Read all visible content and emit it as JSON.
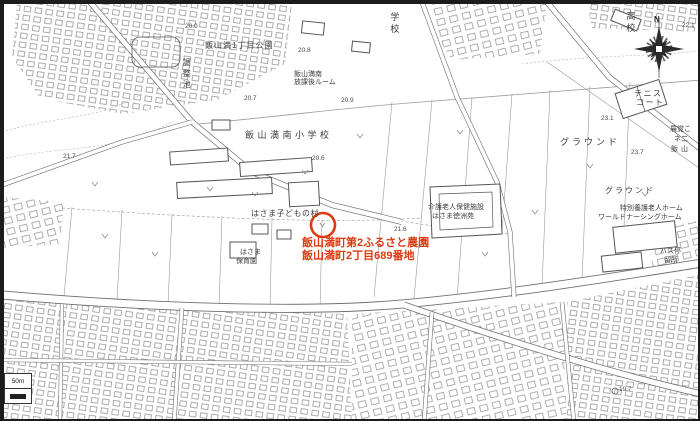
{
  "colors": {
    "accent_red": "#dc3a12",
    "map_line": "#7d7d7d",
    "label_text": "#3c3c3c"
  },
  "annotation": {
    "line1": "飯山満町第2ふるさと農園",
    "line2": "飯山満町2丁目689番地"
  },
  "compass": {
    "north_label": "N"
  },
  "scale": {
    "label": "50m"
  },
  "labels": [
    {
      "text": "学校",
      "x": 387,
      "y": 10,
      "size": 9,
      "vert": true
    },
    {
      "text": "飯山満1丁目公園",
      "x": 203,
      "y": 39,
      "size": 8,
      "ls": 1
    },
    {
      "text": "調整池",
      "x": 180,
      "y": 56,
      "size": 8,
      "vert": true
    },
    {
      "text": "飯山満南",
      "x": 292,
      "y": 69,
      "size": 7
    },
    {
      "text": "放課後ルーム",
      "x": 292,
      "y": 77,
      "size": 7
    },
    {
      "text": "飯山満南小学校",
      "x": 243,
      "y": 128,
      "size": 9,
      "ls": 3.5
    },
    {
      "text": "はさま子どもの村",
      "x": 249,
      "y": 207,
      "size": 8,
      "ls": 0.5
    },
    {
      "text": "はさま",
      "x": 238,
      "y": 247,
      "size": 7
    },
    {
      "text": "保育園",
      "x": 234,
      "y": 256,
      "size": 7
    },
    {
      "text": "介護老人保健施設",
      "x": 426,
      "y": 202,
      "size": 7
    },
    {
      "text": "はさま徳洲苑",
      "x": 430,
      "y": 211,
      "size": 7
    },
    {
      "text": "特別養護老人ホーム",
      "x": 618,
      "y": 203,
      "size": 7
    },
    {
      "text": "ワールドナーシングホーム",
      "x": 596,
      "y": 212,
      "size": 7
    },
    {
      "text": "グラウンド",
      "x": 558,
      "y": 135,
      "size": 9,
      "ls": 3
    },
    {
      "text": "グラウンド",
      "x": 603,
      "y": 184,
      "size": 8,
      "ls": 2
    },
    {
      "text": "テニス",
      "x": 632,
      "y": 87,
      "size": 8,
      "ls": 1.5
    },
    {
      "text": "コート",
      "x": 634,
      "y": 96,
      "size": 8,
      "ls": 1.5
    },
    {
      "text": "高校",
      "x": 623,
      "y": 9,
      "size": 9,
      "vert": true
    },
    {
      "text": "展覚こ",
      "x": 668,
      "y": 124,
      "size": 7
    },
    {
      "text": "ネ二",
      "x": 672,
      "y": 134,
      "size": 7
    },
    {
      "text": "飯山",
      "x": 669,
      "y": 144,
      "size": 7,
      "ls": 3
    },
    {
      "text": "バス停",
      "x": 658,
      "y": 246,
      "size": 7
    },
    {
      "text": "留所",
      "x": 662,
      "y": 255,
      "size": 7
    }
  ],
  "elevations": [
    {
      "text": "20.0",
      "x": 183,
      "y": 21
    },
    {
      "text": "20.8",
      "x": 296,
      "y": 45
    },
    {
      "text": "20.7",
      "x": 242,
      "y": 93
    },
    {
      "text": "20.9",
      "x": 339,
      "y": 95
    },
    {
      "text": "20.6",
      "x": 310,
      "y": 153
    },
    {
      "text": "21.7",
      "x": 61,
      "y": 151
    },
    {
      "text": "21.6",
      "x": 392,
      "y": 224
    },
    {
      "text": "23.1",
      "x": 599,
      "y": 113
    },
    {
      "text": "23.7",
      "x": 629,
      "y": 147
    },
    {
      "text": "22.1",
      "x": 680,
      "y": 20
    },
    {
      "text": "19.7",
      "x": 617,
      "y": 384
    }
  ]
}
